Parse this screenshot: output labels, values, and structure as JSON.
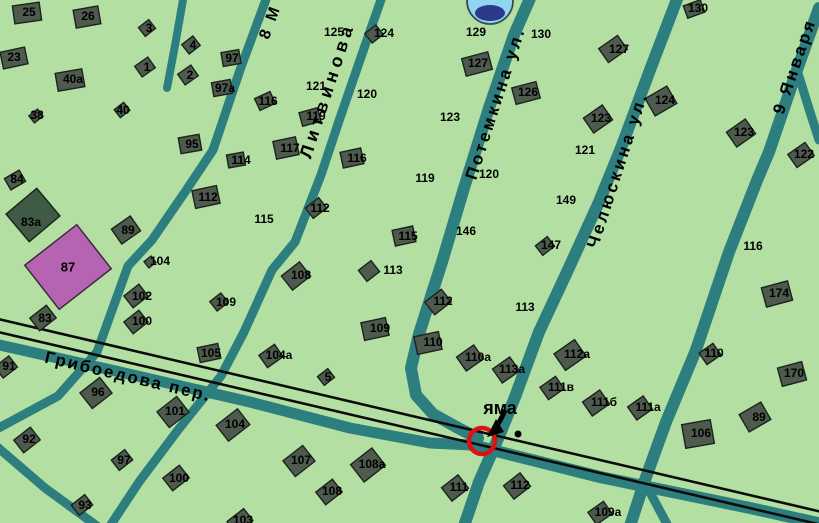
{
  "colors": {
    "background": "#b3e0a2",
    "road": "#2d7e7e",
    "railway": "#0b0b0b",
    "building_fill": "#4e5a4e",
    "building_border": "#1c221c",
    "purple_building_fill": "#b664b2",
    "dark_building_fill": "#3f5a45",
    "pothole_circle": "#dd1111",
    "water_icon_fill": "#8ed7ee",
    "water_icon_dark": "#2b3a8c",
    "label": "#000000"
  },
  "streets": [
    {
      "name": "Грибоедова пер."
    },
    {
      "name": "Литвинова"
    },
    {
      "name": "Потемкина ул."
    },
    {
      "name": "Челюскина ул."
    },
    {
      "name": "9 Января"
    },
    {
      "name": "8 М"
    }
  ],
  "marker": {
    "label": "яма"
  },
  "landmarks": {
    "purple_house": "87",
    "green_house": "83а"
  },
  "houses": [
    {
      "n": "25",
      "x": 29,
      "y": 12,
      "b": [
        27,
        13,
        27,
        18,
        -8
      ]
    },
    {
      "n": "26",
      "x": 88,
      "y": 16,
      "b": [
        87,
        17,
        25,
        18,
        -10
      ]
    },
    {
      "n": "23",
      "x": 14,
      "y": 57,
      "b": [
        14,
        58,
        25,
        17,
        -12
      ]
    },
    {
      "n": "40а",
      "x": 73,
      "y": 79,
      "b": [
        70,
        80,
        27,
        18,
        -10
      ]
    },
    {
      "n": "3",
      "x": 149,
      "y": 28,
      "b": [
        147,
        28,
        13,
        11,
        -38
      ]
    },
    {
      "n": "4",
      "x": 193,
      "y": 45,
      "b": [
        191,
        45,
        14,
        12,
        -38
      ]
    },
    {
      "n": "1",
      "x": 147,
      "y": 67,
      "b": [
        145,
        67,
        16,
        13,
        -35
      ]
    },
    {
      "n": "2",
      "x": 190,
      "y": 75,
      "b": [
        188,
        75,
        16,
        13,
        -35
      ]
    },
    {
      "n": "97",
      "x": 232,
      "y": 58,
      "b": [
        231,
        58,
        18,
        14,
        -10
      ]
    },
    {
      "n": "97а",
      "x": 225,
      "y": 88,
      "b": [
        222,
        88,
        19,
        14,
        -10
      ]
    },
    {
      "n": "38",
      "x": 37,
      "y": 115,
      "b": [
        36,
        116,
        11,
        9,
        -38
      ]
    },
    {
      "n": "40",
      "x": 123,
      "y": 110,
      "b": [
        122,
        110,
        12,
        10,
        -38
      ]
    },
    {
      "n": "95",
      "x": 192,
      "y": 144,
      "b": [
        190,
        144,
        21,
        16,
        -10
      ]
    },
    {
      "n": "114",
      "x": 241,
      "y": 160,
      "b": [
        236,
        160,
        17,
        13,
        -10
      ]
    },
    {
      "n": "116",
      "x": 268,
      "y": 101,
      "b": [
        265,
        101,
        17,
        13,
        -25
      ]
    },
    {
      "n": "84",
      "x": 17,
      "y": 179,
      "b": [
        15,
        180,
        17,
        13,
        -30
      ]
    },
    {
      "n": "89",
      "x": 128,
      "y": 230,
      "b": [
        126,
        230,
        23,
        18,
        -35
      ]
    },
    {
      "n": "83",
      "x": 45,
      "y": 318,
      "b": [
        43,
        318,
        21,
        16,
        -38
      ]
    },
    {
      "n": "104",
      "x": 160,
      "y": 261,
      "b": [
        150,
        262,
        9,
        8,
        -38
      ]
    },
    {
      "n": "102",
      "x": 142,
      "y": 296,
      "b": [
        136,
        296,
        19,
        15,
        -38
      ]
    },
    {
      "n": "100",
      "x": 142,
      "y": 321,
      "b": [
        136,
        322,
        19,
        15,
        -38
      ]
    },
    {
      "n": "112",
      "x": 208,
      "y": 197,
      "b": [
        206,
        197,
        25,
        18,
        -12
      ]
    },
    {
      "n": "115",
      "x": 264,
      "y": 219,
      "b": null
    },
    {
      "n": "109",
      "x": 226,
      "y": 302,
      "b": [
        219,
        302,
        14,
        12,
        -38
      ]
    },
    {
      "n": "105",
      "x": 211,
      "y": 353,
      "b": [
        209,
        353,
        21,
        15,
        -12
      ]
    },
    {
      "n": "91",
      "x": 9,
      "y": 366,
      "b": [
        6,
        367,
        18,
        14,
        -38
      ]
    },
    {
      "n": "92",
      "x": 29,
      "y": 439,
      "b": [
        27,
        440,
        21,
        16,
        -38
      ]
    },
    {
      "n": "96",
      "x": 98,
      "y": 392,
      "b": [
        96,
        393,
        25,
        20,
        -38
      ]
    },
    {
      "n": "101",
      "x": 175,
      "y": 411,
      "b": [
        173,
        412,
        25,
        20,
        -38
      ]
    },
    {
      "n": "104",
      "x": 235,
      "y": 424,
      "b": [
        233,
        425,
        27,
        20,
        -38
      ]
    },
    {
      "n": "97",
      "x": 124,
      "y": 460,
      "b": [
        122,
        460,
        17,
        13,
        -38
      ]
    },
    {
      "n": "100",
      "x": 179,
      "y": 478,
      "b": [
        176,
        478,
        21,
        16,
        -38
      ]
    },
    {
      "n": "93",
      "x": 85,
      "y": 505,
      "b": [
        82,
        505,
        17,
        13,
        -38
      ]
    },
    {
      "n": "103",
      "x": 243,
      "y": 520,
      "b": [
        240,
        521,
        21,
        15,
        -38
      ]
    },
    {
      "n": "125",
      "x": 334,
      "y": 32,
      "b": null
    },
    {
      "n": "124",
      "x": 384,
      "y": 33,
      "b": [
        374,
        34,
        14,
        12,
        -38
      ]
    },
    {
      "n": "121",
      "x": 316,
      "y": 86,
      "b": null
    },
    {
      "n": "120",
      "x": 367,
      "y": 94,
      "b": null
    },
    {
      "n": "119",
      "x": 316,
      "y": 116,
      "b": [
        310,
        117,
        19,
        14,
        -15
      ]
    },
    {
      "n": "117",
      "x": 290,
      "y": 148,
      "b": [
        286,
        148,
        23,
        18,
        -12
      ]
    },
    {
      "n": "116",
      "x": 357,
      "y": 158,
      "b": [
        352,
        158,
        21,
        16,
        -12
      ]
    },
    {
      "n": "112",
      "x": 320,
      "y": 208,
      "b": [
        316,
        208,
        17,
        13,
        -38
      ]
    },
    {
      "n": "115",
      "x": 408,
      "y": 236,
      "b": [
        404,
        236,
        21,
        16,
        -12
      ]
    },
    {
      "n": "113",
      "x": 393,
      "y": 270,
      "b": [
        369,
        271,
        16,
        14,
        -38
      ]
    },
    {
      "n": "108",
      "x": 301,
      "y": 275,
      "b": [
        296,
        276,
        23,
        18,
        -38
      ]
    },
    {
      "n": "109",
      "x": 380,
      "y": 328,
      "b": [
        375,
        329,
        25,
        18,
        -12
      ]
    },
    {
      "n": "110",
      "x": 433,
      "y": 342,
      "b": [
        428,
        343,
        25,
        18,
        -12
      ]
    },
    {
      "n": "112",
      "x": 443,
      "y": 301,
      "b": [
        438,
        302,
        21,
        16,
        -38
      ]
    },
    {
      "n": "113",
      "x": 525,
      "y": 307,
      "b": null
    },
    {
      "n": "123",
      "x": 450,
      "y": 117,
      "b": null
    },
    {
      "n": "119",
      "x": 425,
      "y": 178,
      "b": null
    },
    {
      "n": "120",
      "x": 489,
      "y": 174,
      "b": null
    },
    {
      "n": "146",
      "x": 466,
      "y": 231,
      "b": null
    },
    {
      "n": "147",
      "x": 551,
      "y": 245,
      "b": [
        545,
        246,
        15,
        12,
        -38
      ]
    },
    {
      "n": "149",
      "x": 566,
      "y": 200,
      "b": null
    },
    {
      "n": "129",
      "x": 476,
      "y": 32,
      "b": null
    },
    {
      "n": "130",
      "x": 541,
      "y": 34,
      "b": null
    },
    {
      "n": "127",
      "x": 478,
      "y": 63,
      "b": [
        477,
        64,
        27,
        18,
        -15
      ]
    },
    {
      "n": "126",
      "x": 528,
      "y": 92,
      "b": [
        526,
        93,
        25,
        17,
        -15
      ]
    },
    {
      "n": "127",
      "x": 619,
      "y": 49,
      "b": [
        613,
        49,
        23,
        17,
        -35
      ]
    },
    {
      "n": "130",
      "x": 698,
      "y": 8,
      "b": [
        694,
        9,
        18,
        13,
        -20
      ]
    },
    {
      "n": "124",
      "x": 665,
      "y": 100,
      "b": [
        661,
        101,
        25,
        20,
        -30
      ]
    },
    {
      "n": "123",
      "x": 601,
      "y": 118,
      "b": [
        598,
        119,
        23,
        18,
        -35
      ]
    },
    {
      "n": "121",
      "x": 585,
      "y": 150,
      "b": null
    },
    {
      "n": "123",
      "x": 744,
      "y": 132,
      "b": [
        741,
        133,
        23,
        18,
        -35
      ]
    },
    {
      "n": "122",
      "x": 804,
      "y": 154,
      "b": [
        801,
        155,
        21,
        16,
        -35
      ]
    },
    {
      "n": "116",
      "x": 753,
      "y": 246,
      "b": null
    },
    {
      "n": "174",
      "x": 779,
      "y": 293,
      "b": [
        777,
        294,
        27,
        20,
        -15
      ]
    },
    {
      "n": "170",
      "x": 794,
      "y": 373,
      "b": [
        792,
        374,
        25,
        19,
        -15
      ]
    },
    {
      "n": "110",
      "x": 714,
      "y": 353,
      "b": [
        710,
        354,
        17,
        14,
        -35
      ]
    },
    {
      "n": "89",
      "x": 759,
      "y": 417,
      "b": [
        755,
        417,
        25,
        20,
        -30
      ]
    },
    {
      "n": "106",
      "x": 701,
      "y": 433,
      "b": [
        698,
        434,
        29,
        24,
        -10
      ]
    },
    {
      "n": "112а",
      "x": 577,
      "y": 354,
      "b": [
        570,
        355,
        25,
        20,
        -35
      ]
    },
    {
      "n": "111в",
      "x": 561,
      "y": 387,
      "b": [
        552,
        388,
        19,
        15,
        -35
      ]
    },
    {
      "n": "111б",
      "x": 604,
      "y": 402,
      "b": [
        596,
        403,
        21,
        17,
        -35
      ]
    },
    {
      "n": "111а",
      "x": 648,
      "y": 407,
      "b": [
        640,
        408,
        19,
        16,
        -35
      ]
    },
    {
      "n": "109а",
      "x": 608,
      "y": 512,
      "b": [
        600,
        513,
        19,
        15,
        -35
      ]
    },
    {
      "n": "110а",
      "x": 478,
      "y": 357,
      "b": [
        470,
        358,
        21,
        17,
        -35
      ]
    },
    {
      "n": "113а",
      "x": 512,
      "y": 369,
      "b": [
        506,
        370,
        21,
        17,
        -35
      ]
    },
    {
      "n": "5",
      "x": 328,
      "y": 377,
      "b": [
        326,
        377,
        13,
        11,
        -38
      ]
    },
    {
      "n": "104а",
      "x": 279,
      "y": 355,
      "b": [
        271,
        356,
        19,
        15,
        -35
      ]
    },
    {
      "n": "107",
      "x": 301,
      "y": 460,
      "b": [
        299,
        461,
        25,
        20,
        -38
      ]
    },
    {
      "n": "108а",
      "x": 372,
      "y": 464,
      "b": [
        368,
        465,
        27,
        22,
        -38
      ]
    },
    {
      "n": "108",
      "x": 332,
      "y": 491,
      "b": [
        329,
        492,
        21,
        16,
        -38
      ]
    },
    {
      "n": "111",
      "x": 459,
      "y": 487,
      "b": [
        455,
        488,
        21,
        17,
        -38
      ]
    },
    {
      "n": "112",
      "x": 520,
      "y": 485,
      "b": [
        517,
        486,
        21,
        17,
        -38
      ]
    }
  ]
}
